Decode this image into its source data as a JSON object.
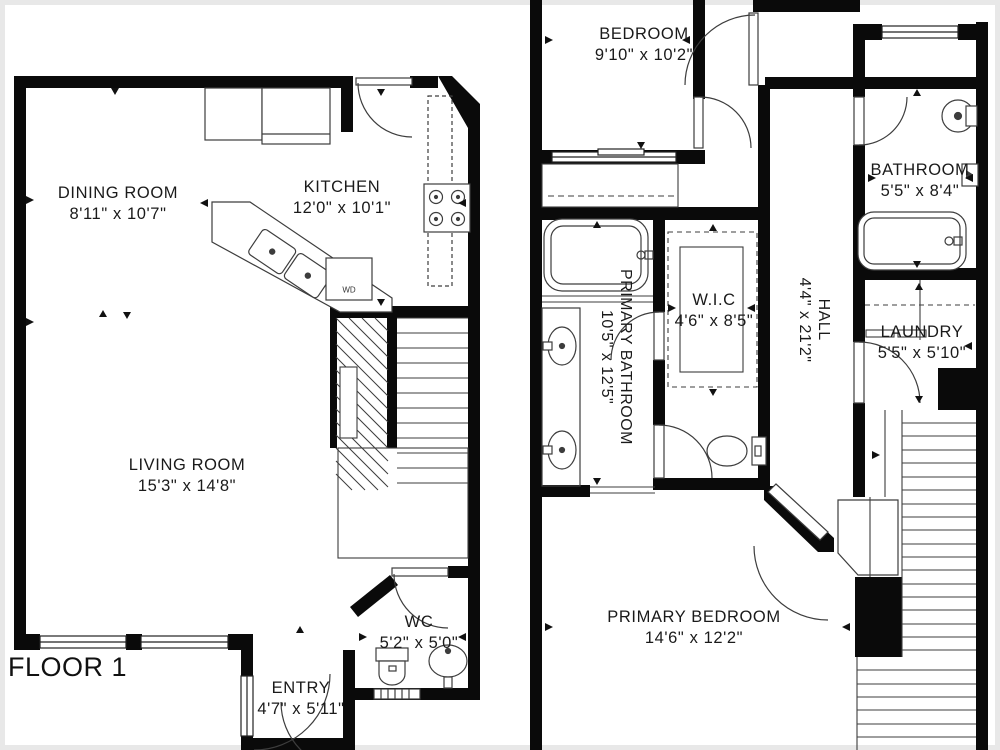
{
  "floor_label": "FLOOR 1",
  "floors": {
    "floor1": {
      "rooms": {
        "dining": {
          "name": "DINING ROOM",
          "dims": "8'11\" x 10'7\""
        },
        "kitchen": {
          "name": "KITCHEN",
          "dims": "12'0\" x 10'1\""
        },
        "living": {
          "name": "LIVING ROOM",
          "dims": "15'3\" x 14'8\""
        },
        "wc": {
          "name": "WC",
          "dims": "5'2\" x 5'0\""
        },
        "entry": {
          "name": "ENTRY",
          "dims": "4'7\" x 5'11\""
        }
      },
      "appliances": {
        "washer_dryer": "WD"
      }
    },
    "floor2": {
      "rooms": {
        "bedroom": {
          "name": "BEDROOM",
          "dims": "9'10\" x 10'2\""
        },
        "bathroom": {
          "name": "BATHROOM",
          "dims": "5'5\" x 8'4\""
        },
        "primary_bathroom": {
          "name": "PRIMARY BATHROOM",
          "dims": "10'5\" x 12'5\""
        },
        "wic": {
          "name": "W.I.C",
          "dims": "4'6\" x 8'5\""
        },
        "hall": {
          "name": "HALL",
          "dims": "4'4\" x 21'2\""
        },
        "laundry": {
          "name": "LAUNDRY",
          "dims": "5'5\" x 5'10\""
        },
        "primary_bedroom": {
          "name": "PRIMARY BEDROOM",
          "dims": "14'6\" x 12'2\""
        }
      }
    }
  },
  "colors": {
    "wall": "#0a0a0a",
    "fixture_line": "#3d3d3d",
    "text": "#1a1a1a",
    "background": "#ffffff",
    "frame": "#e8e8e8"
  }
}
